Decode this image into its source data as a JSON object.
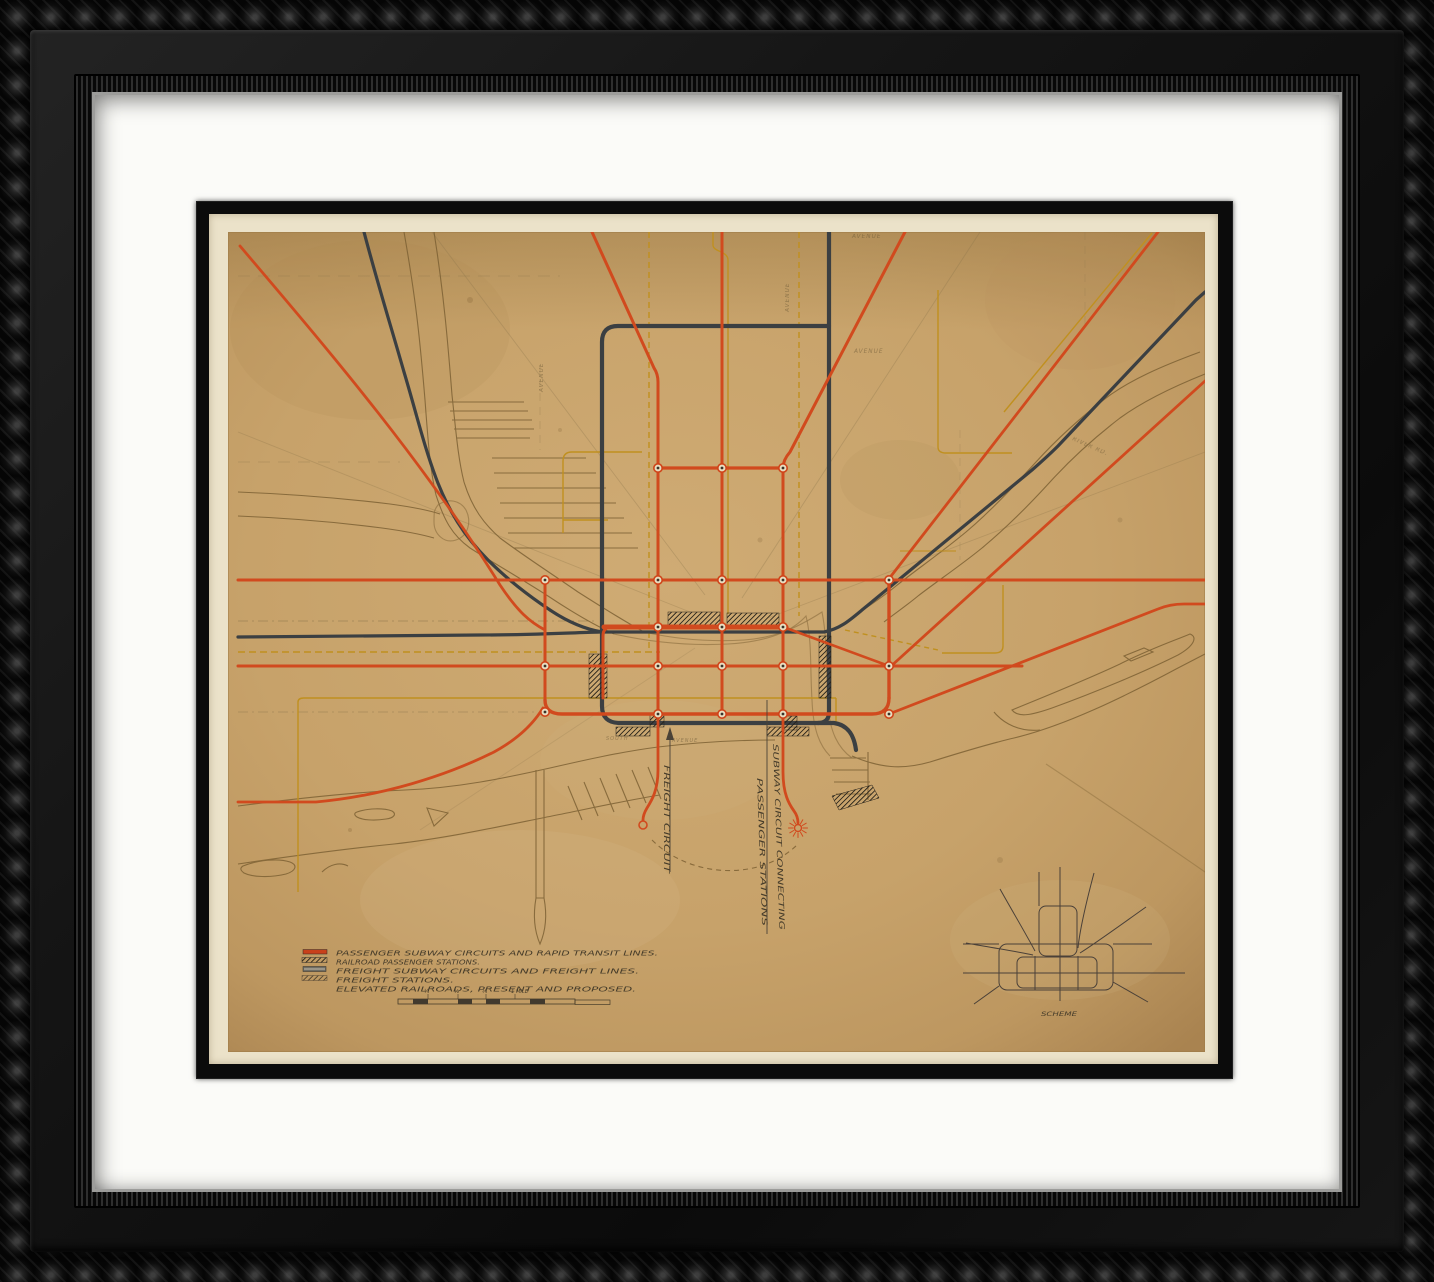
{
  "artwork": {
    "colors": {
      "passenger_line_orange": "#d14a1e",
      "freight_line_gray": "#3b3f42",
      "elevated_line_yellow": "#c0901f",
      "river_brown": "#7d6134",
      "map_paper_tan": "#c7a26a",
      "sheet_cream": "#ebe2c9",
      "mat_white": "#fbfbf8",
      "frame_black": "#0d0d0d",
      "ink_brown": "#463c2a"
    },
    "legend": {
      "items": [
        {
          "swatch": "orange-line",
          "label": "PASSENGER SUBWAY CIRCUITS AND RAPID TRANSIT LINES."
        },
        {
          "swatch": "black-hatch",
          "label": "RAILROAD PASSENGER STATIONS."
        },
        {
          "swatch": "gray-line",
          "label": "FREIGHT SUBWAY CIRCUITS AND FREIGHT LINES."
        },
        {
          "swatch": "light-hatch",
          "label": "FREIGHT STATIONS."
        },
        {
          "swatch": "none",
          "label": "ELEVATED RAILROADS, PRESENT AND PROPOSED."
        }
      ]
    },
    "scale_bar": {
      "ticks": [
        "¼",
        "½",
        "¾",
        "1 MILE"
      ]
    },
    "annotations": {
      "freight_circuit": "FREIGHT CIRCUIT",
      "subway_circuit_line1": "SUBWAY CIRCUIT CONNECTING",
      "subway_circuit_line2": "PASSENGER STATIONS",
      "scheme_caption": "SCHEME"
    },
    "street_labels": [
      {
        "text": "AVENUE"
      },
      {
        "text": "AVENUE"
      },
      {
        "text": "AVENUE"
      },
      {
        "text": "AVENUE"
      },
      {
        "text": "RIVER RD."
      },
      {
        "text": "SOUTH"
      },
      {
        "text": "AVENUE"
      }
    ]
  }
}
